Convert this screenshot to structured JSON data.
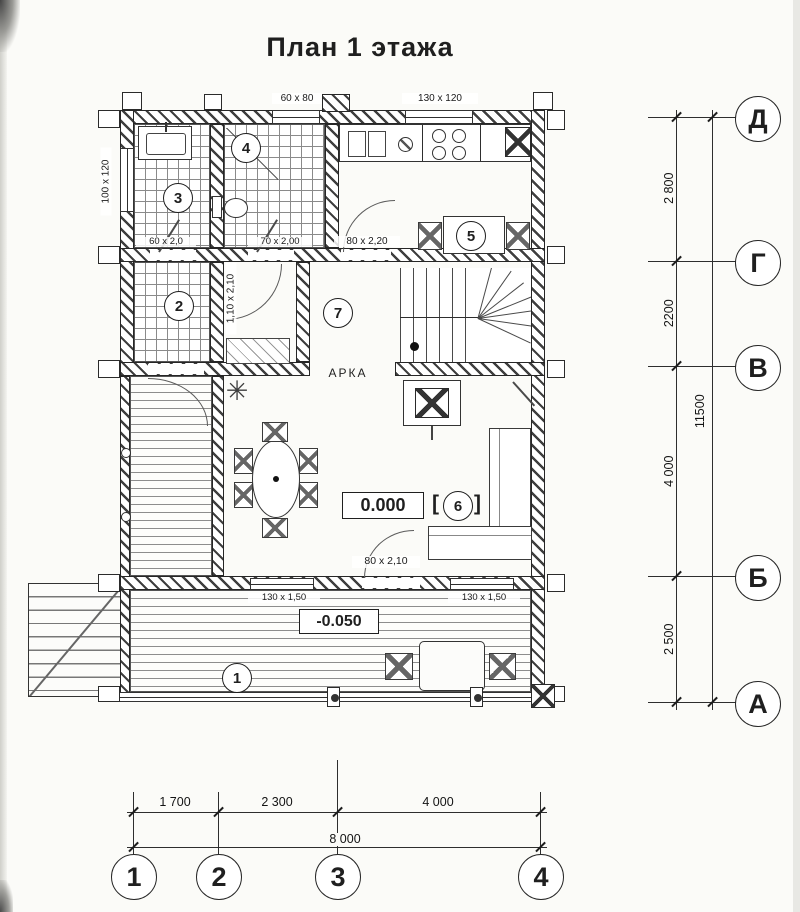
{
  "title": "План  1 этажа",
  "plan": {
    "rooms": [
      "1",
      "2",
      "3",
      "4",
      "5",
      "6",
      "7"
    ],
    "labels": {
      "arch": "АРКА",
      "level_ground": "0.000",
      "level_terrace": "-0.050",
      "bracket_l": "[",
      "bracket_r": "]"
    },
    "openings": {
      "vent": "60 x 80",
      "kitchen_window": "130 x 120",
      "left_window": "100 x 120",
      "sauna_door": "60 x 2,0",
      "shower_door": "70 x 2,00",
      "kitchen_door": "80 x 2,20",
      "room2_door": "1,10 x 2,10",
      "terrace_door": "80 x 2,10",
      "window_bottom_left": "130 x 1,50",
      "window_bottom_right": "130 x 1,50"
    },
    "icons": {
      "plant": "✳"
    }
  },
  "grid": {
    "rows": [
      "Д",
      "Г",
      "В",
      "Б",
      "А"
    ],
    "cols": [
      "1",
      "2",
      "3",
      "4"
    ],
    "row_dims": [
      "2 800",
      "2200",
      "4 000",
      "2 500"
    ],
    "row_total": "11500",
    "col_dims": [
      "1 700",
      "2 300",
      "4 000"
    ],
    "col_total": "8 000"
  },
  "colors": {
    "ink": "#1f1f1f",
    "paper": "#fbfbf8"
  }
}
